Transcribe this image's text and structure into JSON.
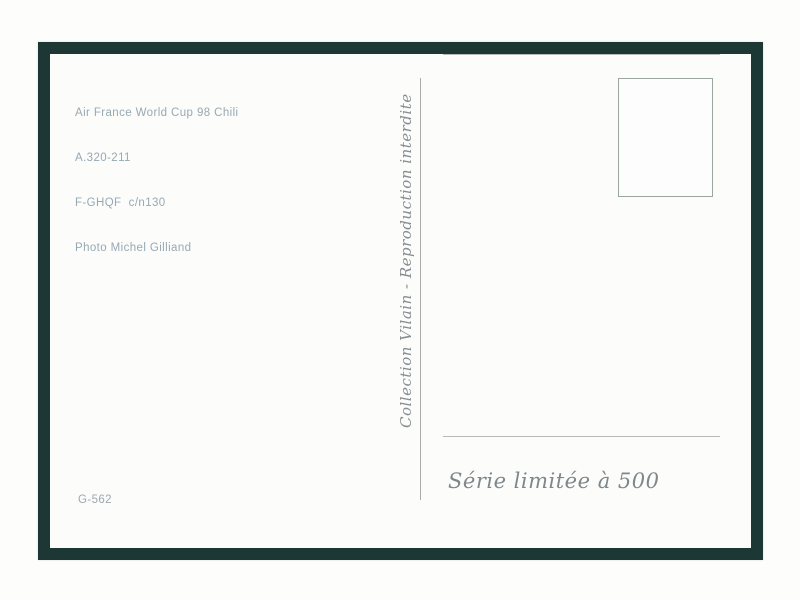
{
  "postcard": {
    "caption": {
      "lines": [
        "Air France World Cup 98 Chili",
        "A.320-211",
        "F-GHQF  c/n130",
        "Photo Michel Gilliand"
      ]
    },
    "collection_text": "Collection Vilain - Reproduction interdite",
    "serie_text": "Série limitée à 500",
    "reference": "G-562",
    "address_lines_count": 5,
    "colors": {
      "frame_green": "#1d3834",
      "caption_text": "#97a9b3",
      "script_text": "#878e92",
      "rule_gray": "#b6bab9"
    }
  }
}
